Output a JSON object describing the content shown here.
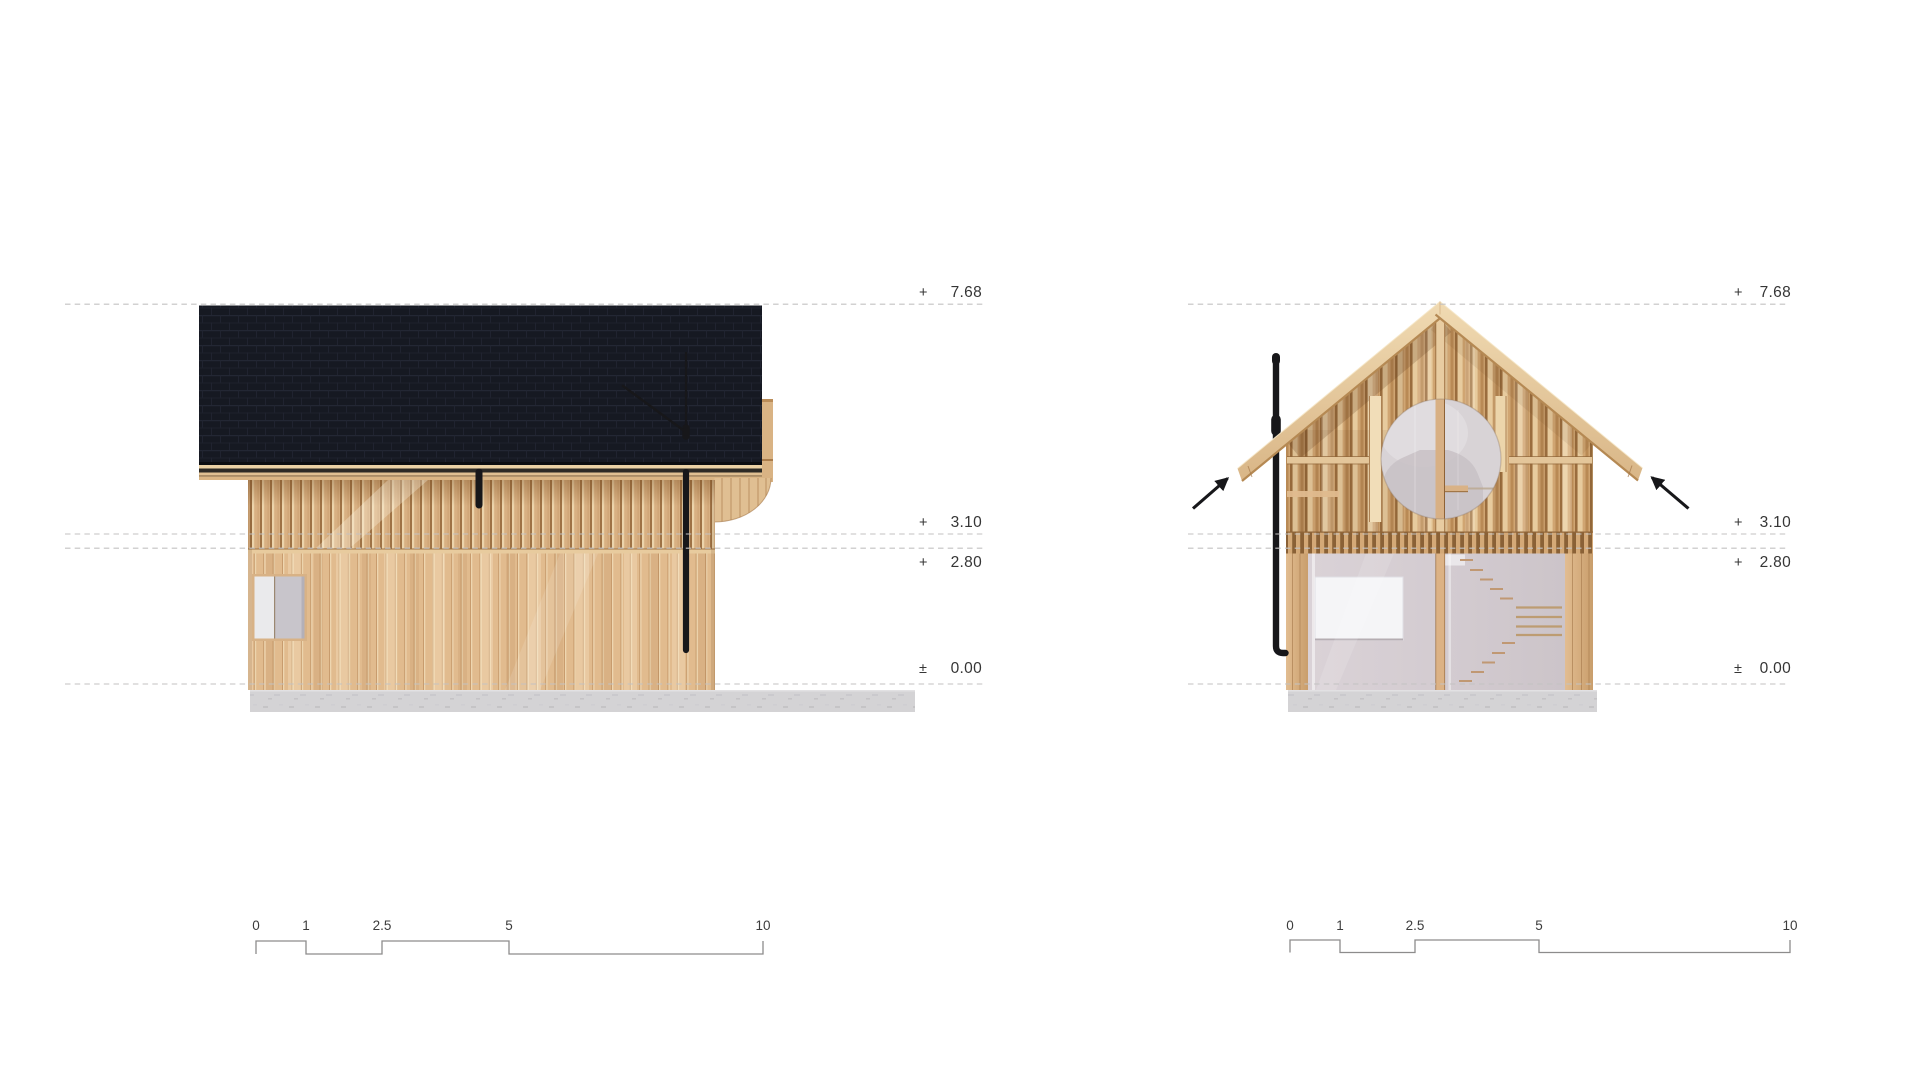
{
  "sheet": {
    "background": "#ffffff"
  },
  "drawings": [
    {
      "id": "side-elevation",
      "levels": [
        {
          "sign": "+",
          "value": "7.68"
        },
        {
          "sign": "+",
          "value": "3.10"
        },
        {
          "sign": "+",
          "value": "2.80"
        },
        {
          "sign": "±",
          "value": "0.00"
        }
      ],
      "scalebar": {
        "labels": [
          "0",
          "1",
          "2.5",
          "5",
          "10"
        ]
      }
    },
    {
      "id": "cross-section",
      "levels": [
        {
          "sign": "+",
          "value": "7.68"
        },
        {
          "sign": "+",
          "value": "3.10"
        },
        {
          "sign": "+",
          "value": "2.80"
        },
        {
          "sign": "±",
          "value": "0.00"
        }
      ],
      "scalebar": {
        "labels": [
          "0",
          "1",
          "2.5",
          "5",
          "10"
        ]
      }
    }
  ],
  "colors": {
    "roof_shingle": "#161922",
    "timber_light": "#ecd5ab",
    "timber_mid": "#d9b183",
    "timber_dark": "#9e7245",
    "concrete": "#d4d3d5",
    "glass": "#d8d3d6",
    "interior_wall": "#d5cdd2",
    "pipe_black": "#17171a",
    "dash_line": "#c3c2c2",
    "bar_line": "#8d8c8c",
    "label_text": "#353535"
  }
}
